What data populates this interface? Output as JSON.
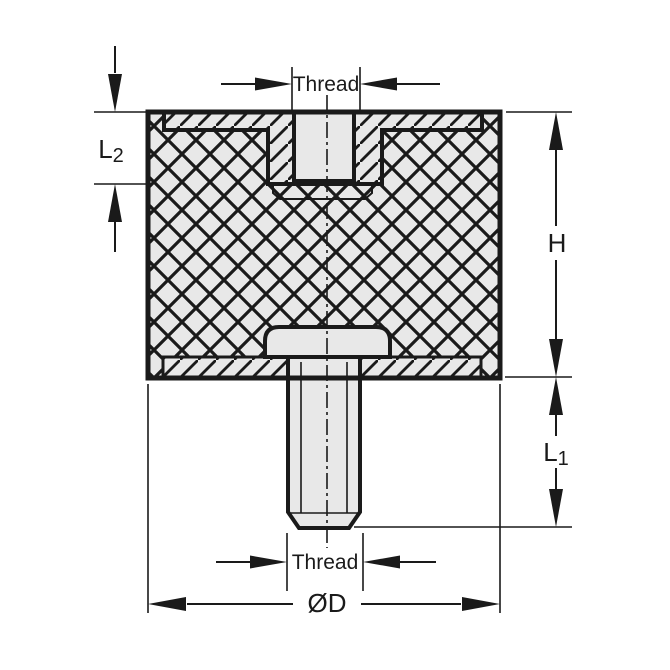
{
  "title": "Vibration mount cross-section drawing",
  "labels": {
    "thread_top": "Thread",
    "thread_bottom": "Thread",
    "h": "H",
    "od": "ØD",
    "l1_main": "L",
    "l1_sub": "1",
    "l2_main": "L",
    "l2_sub": "2"
  },
  "colors": {
    "line": "#1a1a1a",
    "part_fill": "#e8e8e8",
    "background": "#ffffff"
  }
}
